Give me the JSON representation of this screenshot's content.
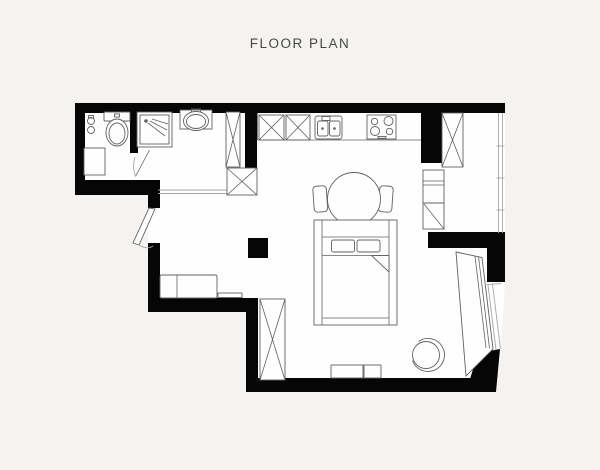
{
  "title": "FLOOR PLAN",
  "palette": {
    "background": "#f4f3f1",
    "floor": "#fefefe",
    "wall": "#060606",
    "line": "#616161",
    "line_light": "#a6a6a6",
    "title_color": "#474747"
  },
  "plan": {
    "type": "studio-apartment-floor-plan",
    "rooms": [
      "wc",
      "shower-room",
      "entry-hall",
      "kitchen",
      "living-sleeping-area"
    ],
    "furniture": {
      "wc": [
        "toilet",
        "wall-accessories",
        "washer-cabinet"
      ],
      "shower_room": [
        "shower-cabin",
        "vanity-sink",
        "tall-cabinet",
        "interior-door"
      ],
      "entry_hall": [
        "entry-door",
        "bench-sofa",
        "low-shelf",
        "storage-cabinet"
      ],
      "kitchen": [
        "base-cabinet-1",
        "base-cabinet-2",
        "double-sink",
        "cooktop",
        "tall-fridge-cabinet",
        "appliance-stack",
        "corner-cabinet"
      ],
      "living_area": [
        "round-dining-table",
        "dining-chair-left",
        "dining-chair-right",
        "double-bed",
        "wardrobe",
        "structural-column",
        "drawer-bench",
        "armchair",
        "window-desk"
      ]
    },
    "windows": [
      "right-window",
      "angled-bay-window"
    ]
  }
}
